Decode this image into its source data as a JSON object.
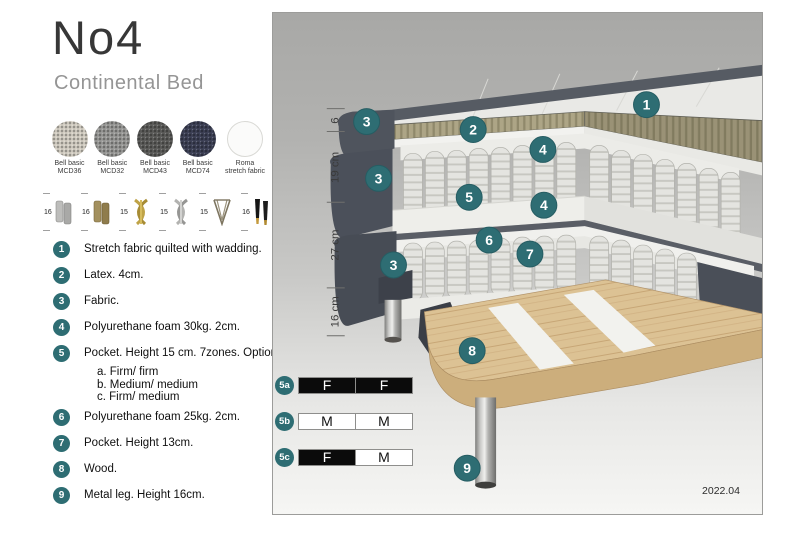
{
  "page": {
    "title": "No4",
    "subtitle": "Continental Bed",
    "version": "2022.04"
  },
  "colors": {
    "accent_teal": "#2e6d73",
    "panel_gray_top": "#a8a8a6",
    "panel_gray_bottom": "#f6f6f4",
    "dark_fabric": "#4e535c",
    "latex_khaki": "#ada586",
    "wood": "#dcc294"
  },
  "fabrics": [
    {
      "name": "Bell basic",
      "code": "MCD36",
      "base": "#d6d1c6"
    },
    {
      "name": "Bell basic",
      "code": "MCD32",
      "base": "#9c9c9a"
    },
    {
      "name": "Bell basic",
      "code": "MCD43",
      "base": "#5e5e5c"
    },
    {
      "name": "Bell basic",
      "code": "MCD74",
      "base": "#3e4257"
    },
    {
      "name": "Roma",
      "code": "stretch fabric",
      "base": "#fbfbfa"
    }
  ],
  "legs": [
    {
      "height": "16",
      "name": "cylinder-silver"
    },
    {
      "height": "16",
      "name": "cylinder-bronze"
    },
    {
      "height": "15",
      "name": "twist-gold"
    },
    {
      "height": "15",
      "name": "twist-silver"
    },
    {
      "height": "15",
      "name": "hairpin"
    },
    {
      "height": "16",
      "name": "tapered-black-gold"
    }
  ],
  "parts": [
    {
      "num": "1",
      "text": "Stretch fabric quilted with wadding."
    },
    {
      "num": "2",
      "text": "Latex. 4cm."
    },
    {
      "num": "3",
      "text": "Fabric."
    },
    {
      "num": "4",
      "text": "Polyurethane foam 30kg. 2cm."
    },
    {
      "num": "5",
      "text": "Pocket. Height 15 cm. 7zones. Option:",
      "options": [
        "a. Firm/ firm",
        "b. Medium/ medium",
        "c. Firm/ medium"
      ]
    },
    {
      "num": "6",
      "text": "Polyurethane foam 25kg. 2cm."
    },
    {
      "num": "7",
      "text": "Pocket. Height 13cm."
    },
    {
      "num": "8",
      "text": "Wood."
    },
    {
      "num": "9",
      "text": "Metal leg. Height 16cm."
    }
  ],
  "diagram": {
    "dimensions": [
      "6",
      "19 cm",
      "27 cm",
      "16 cm"
    ],
    "callouts": [
      "1",
      "2",
      "3",
      "3",
      "3",
      "4",
      "4",
      "5",
      "6",
      "7",
      "8",
      "9"
    ],
    "firmness": [
      {
        "label": "5a",
        "cells": [
          {
            "letter": "F",
            "style": "dark"
          },
          {
            "letter": "F",
            "style": "dark"
          }
        ]
      },
      {
        "label": "5b",
        "cells": [
          {
            "letter": "M",
            "style": "light"
          },
          {
            "letter": "M",
            "style": "light"
          }
        ]
      },
      {
        "label": "5c",
        "cells": [
          {
            "letter": "F",
            "style": "dark"
          },
          {
            "letter": "M",
            "style": "light"
          }
        ]
      }
    ]
  }
}
